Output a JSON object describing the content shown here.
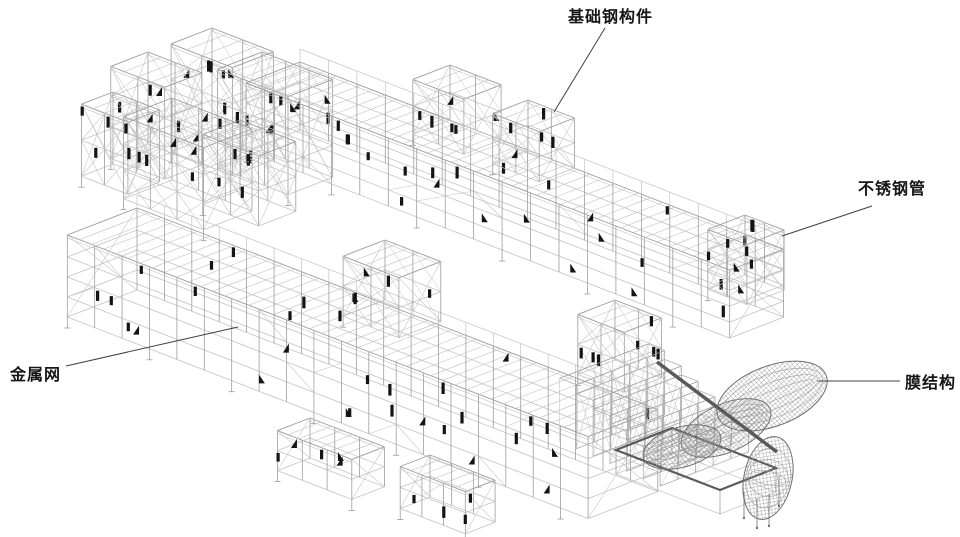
{
  "canvas": {
    "width": 960,
    "height": 537,
    "background": "#ffffff"
  },
  "colors": {
    "background": "#ffffff",
    "line_light": "#c3c3c3",
    "line_mid": "#9c9c9c",
    "line_dark": "#707070",
    "accent_black": "#141414",
    "membrane_mesh": "#8d8d8d",
    "beam_dark": "#5a5a5a",
    "leader": "#3f3f3f",
    "label_text": "#161616"
  },
  "labels": [
    {
      "id": "foundation-steel",
      "text": "基础钢构件",
      "x": 568,
      "y": 8,
      "leader": {
        "x1": 605,
        "y1": 28,
        "x2": 554,
        "y2": 112
      }
    },
    {
      "id": "stainless-pipe",
      "text": "不锈钢管",
      "x": 858,
      "y": 180,
      "leader": {
        "x1": 872,
        "y1": 206,
        "x2": 782,
        "y2": 236
      }
    },
    {
      "id": "metal-mesh",
      "text": "金属网",
      "x": 10,
      "y": 366,
      "leader": {
        "x1": 66,
        "y1": 366,
        "x2": 238,
        "y2": 327
      }
    },
    {
      "id": "membrane",
      "text": "膜结构",
      "x": 905,
      "y": 374,
      "leader": {
        "x1": 900,
        "y1": 381,
        "x2": 818,
        "y2": 381
      }
    }
  ],
  "figure": {
    "iso": {
      "u": [
        0.93,
        0.36
      ],
      "v": [
        -0.93,
        0.36
      ]
    },
    "structures": [
      {
        "name": "corner-tower-a",
        "type": "bar",
        "origin": [
          148,
          52
        ],
        "len": 58,
        "wid": 40,
        "h": 92,
        "levels": [
          30,
          60
        ],
        "post": 29,
        "joist": 14,
        "braces": "x",
        "accents": 6
      },
      {
        "name": "corner-tower-b",
        "type": "bar",
        "origin": [
          212,
          28
        ],
        "len": 66,
        "wid": 44,
        "h": 108,
        "levels": [
          36,
          72
        ],
        "post": 33,
        "joist": 15,
        "braces": "x",
        "accents": 7
      },
      {
        "name": "corner-tower-c",
        "type": "bar",
        "origin": [
          113,
          92
        ],
        "len": 50,
        "wid": 34,
        "h": 72,
        "levels": [
          36
        ],
        "post": 25,
        "joist": 12,
        "braces": "x",
        "accents": 4
      },
      {
        "name": "corner-tower-d",
        "type": "bar",
        "origin": [
          262,
          52
        ],
        "len": 76,
        "wid": 48,
        "h": 98,
        "levels": [
          33,
          66
        ],
        "post": 26,
        "joist": 13,
        "braces": "x",
        "accents": 8
      },
      {
        "name": "corner-tower-e",
        "type": "bar",
        "origin": [
          172,
          98
        ],
        "len": 86,
        "wid": 52,
        "h": 82,
        "levels": [
          27,
          54
        ],
        "post": 29,
        "joist": 13,
        "braces": "x",
        "accents": 8
      },
      {
        "name": "corner-tower-f",
        "type": "bar",
        "origin": [
          240,
          120
        ],
        "len": 60,
        "wid": 40,
        "h": 70,
        "levels": [
          35
        ],
        "post": 30,
        "joist": 13,
        "braces": "x",
        "accents": 5
      },
      {
        "name": "upper-bar",
        "type": "bar",
        "origin": [
          300,
          62
        ],
        "len": 520,
        "wid": 58,
        "h": 68,
        "levels": [
          20,
          36,
          52
        ],
        "post": 30,
        "joist": 13,
        "parapet": true,
        "accents": 24
      },
      {
        "name": "upper-bar-tower-1",
        "type": "bar",
        "origin": [
          450,
          65
        ],
        "len": 55,
        "wid": 40,
        "h": 55,
        "levels": [
          27
        ],
        "post": 27,
        "joist": 13,
        "braces": "x",
        "accents": 6
      },
      {
        "name": "upper-bar-tower-2",
        "type": "bar",
        "origin": [
          528,
          100
        ],
        "len": 50,
        "wid": 38,
        "h": 50,
        "levels": [
          25
        ],
        "post": 25,
        "joist": 12,
        "braces": "x",
        "accents": 5
      },
      {
        "name": "upper-bar-end-tower",
        "type": "bar",
        "origin": [
          745,
          215
        ],
        "len": 42,
        "wid": 40,
        "h": 60,
        "levels": [
          20,
          40
        ],
        "post": 21,
        "joist": 11,
        "braces": "x",
        "accents": 8
      },
      {
        "name": "lower-bar",
        "type": "bar",
        "origin": [
          137,
          208
        ],
        "len": 560,
        "wid": 75,
        "h": 82,
        "levels": [
          22,
          42,
          62
        ],
        "post": 30,
        "joist": 13,
        "parapet": true,
        "accents": 30
      },
      {
        "name": "lower-bar-tower-1",
        "type": "bar",
        "origin": [
          385,
          240
        ],
        "len": 60,
        "wid": 45,
        "h": 60,
        "levels": [
          30
        ],
        "post": 30,
        "joist": 13,
        "braces": "x",
        "accents": 6
      },
      {
        "name": "lower-bar-tower-2",
        "type": "bar",
        "origin": [
          615,
          300
        ],
        "len": 50,
        "wid": 40,
        "h": 60,
        "levels": [
          30
        ],
        "post": 25,
        "joist": 12,
        "braces": "x",
        "accents": 7
      },
      {
        "name": "front-module-1",
        "type": "bar",
        "origin": [
          310,
          418
        ],
        "len": 80,
        "wid": 35,
        "h": 40,
        "levels": [
          20
        ],
        "post": 27,
        "joist": 12,
        "accents": 5
      },
      {
        "name": "front-module-2",
        "type": "bar",
        "origin": [
          430,
          455
        ],
        "len": 70,
        "wid": 32,
        "h": 42,
        "levels": [
          21
        ],
        "post": 23,
        "joist": 12,
        "accents": 4
      },
      {
        "name": "grandstand-steps",
        "type": "steps",
        "origin": [
          648,
          344
        ],
        "count": 6,
        "stripLen": 95,
        "stepW": 18,
        "shift": 18,
        "drop": 9,
        "h0": 64
      }
    ],
    "membrane": {
      "lobes": [
        {
          "cx": 726,
          "cy": 428,
          "rx": 48,
          "ry": 24,
          "rot": -24
        },
        {
          "cx": 682,
          "cy": 447,
          "rx": 40,
          "ry": 20,
          "rot": -16
        },
        {
          "cx": 772,
          "cy": 396,
          "rx": 58,
          "ry": 30,
          "rot": -21
        },
        {
          "cx": 768,
          "cy": 478,
          "rx": 24,
          "ry": 42,
          "rot": 12
        }
      ],
      "beam": [
        657,
        362,
        777,
        452
      ],
      "stage": [
        [
          672,
          428
        ],
        [
          776,
          468
        ],
        [
          720,
          490
        ],
        [
          616,
          450
        ]
      ],
      "tethers": [
        [
          744,
          492,
          26
        ],
        [
          757,
          498,
          30
        ],
        [
          769,
          494,
          32
        ],
        [
          779,
          476,
          30
        ]
      ]
    }
  }
}
